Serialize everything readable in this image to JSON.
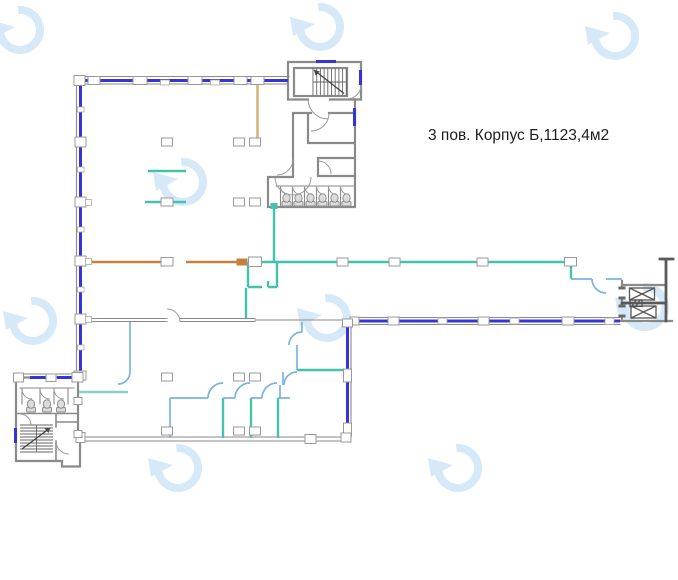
{
  "annotation": {
    "label": "3 пов. Корпус Б,1123,4м2"
  },
  "colors": {
    "background": "#ffffff",
    "window_blue": "#3434d8",
    "wall_gray": "#8a8a8a",
    "wall_dark": "#5a5a5a",
    "wall_teal": "#45c2ac",
    "wall_teal_light": "#8ad2c8",
    "wall_orange": "#c5813c",
    "wall_tan": "#d9b27d",
    "wall_light_blue": "#7ab4e2",
    "watermark_blue": "#d6e9f8",
    "fixture_fill": "#dcdcdc",
    "fixture_stroke": "#8f8f8f",
    "label_color": "#1d1d1d"
  },
  "watermarks": {
    "positions": [
      [
        20,
        30
      ],
      [
        320,
        27
      ],
      [
        615,
        36
      ],
      [
        183,
        182
      ],
      [
        33,
        321
      ],
      [
        327,
        318
      ],
      [
        645,
        307
      ],
      [
        178,
        468
      ],
      [
        458,
        468
      ]
    ]
  }
}
